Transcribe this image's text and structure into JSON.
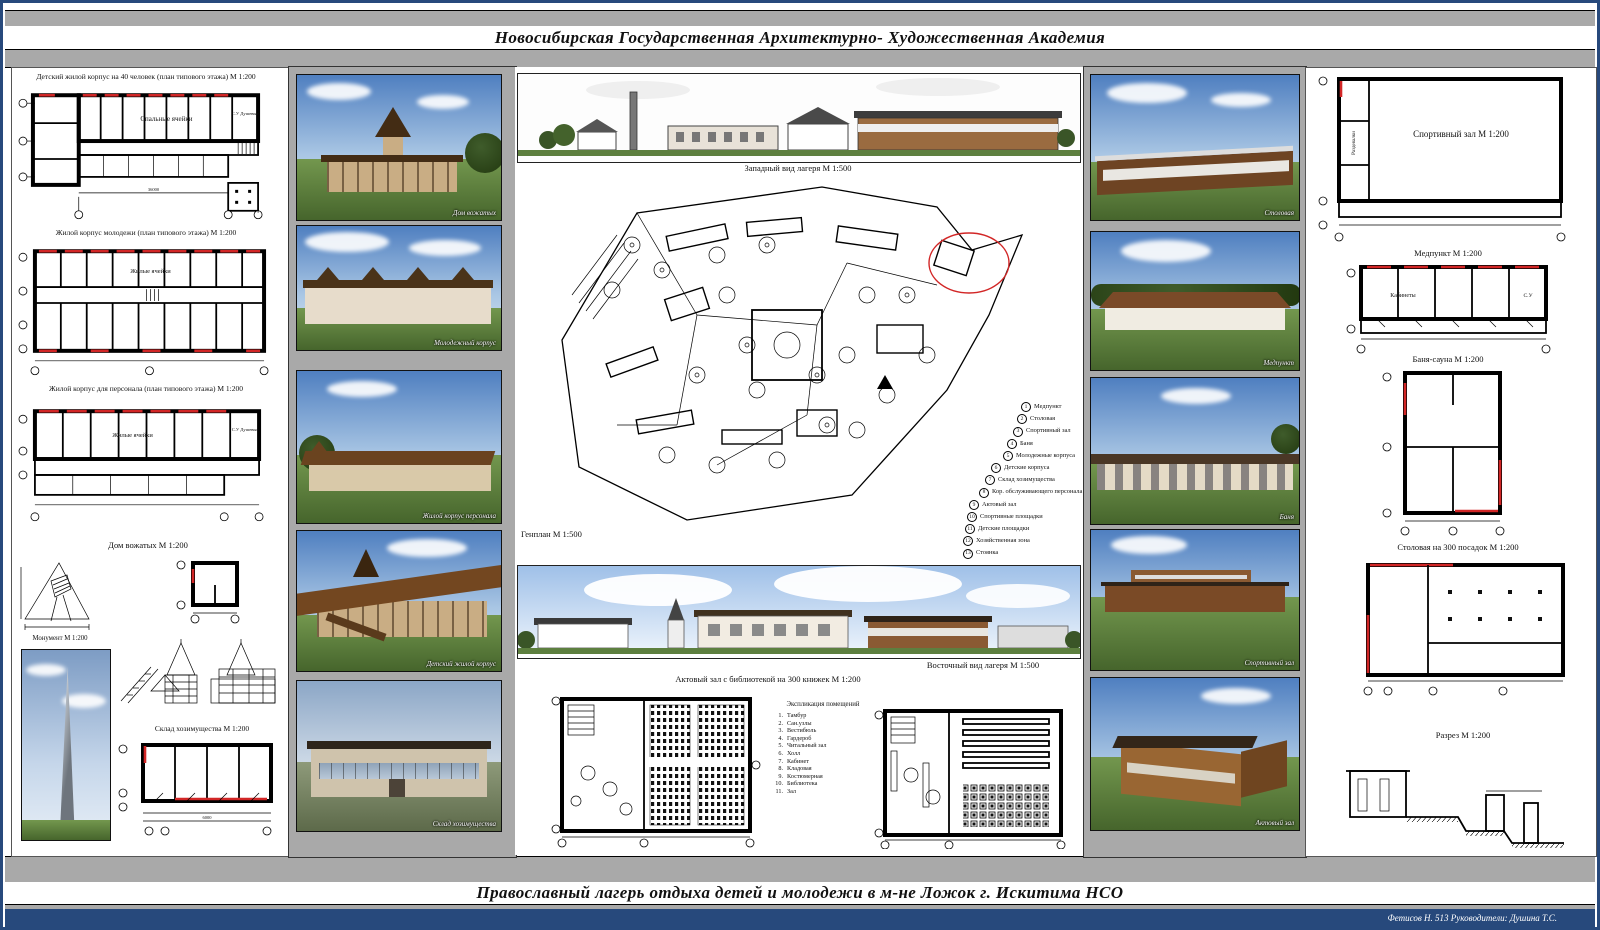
{
  "colors": {
    "accent_red": "#cc2222",
    "frame_gray": "#a9a9a9",
    "border_navy": "#27497c"
  },
  "header": {
    "academy": "Новосибирская Государственная Архитектурно- Художественная Академия"
  },
  "footer": {
    "project": "Православный лагерь отдыха детей и молодежи в м-не Ложок г. Искитима  НСО",
    "credits": "Фетисов Н. 513  Руководители: Душина Т.С."
  },
  "left": {
    "plan1": {
      "caption": "Детский жилой корпус на 40 человек (план типового этажа) М 1:200",
      "room1": "Спальные ячейки",
      "room2": "С.У Душевые"
    },
    "plan2": {
      "caption": "Жилой корпус молодежи (план типового этажа) М 1:200",
      "room1": "Жилые ячейки"
    },
    "plan3": {
      "caption": "Жилой корпус для персонала (план типового этажа) М 1:200",
      "room1": "Жилые ячейки",
      "room2": "С.У Душевые"
    },
    "dom": "Дом вожатых М 1:200",
    "monument": "Монумент М 1:200",
    "sklad": "Склад хозимущества М 1:200",
    "dims": {
      "cell": "6000",
      "total": "36000"
    }
  },
  "renders_left": [
    "Дом вожатых",
    "Молодежный корпус",
    "Жилой корпус персонала",
    "Детский жилой корпус",
    "Склад хозимущества"
  ],
  "center": {
    "west": "Западный вид лагеря М 1:500",
    "genplan": "Генплан М 1:500",
    "east": "Восточный вид лагеря М 1:500",
    "hall": "Актовый зал с библиотекой на 300 книжек М 1:200",
    "expl_title": "Экспликация помещений",
    "legend": [
      "Медпункт",
      "Столовая",
      "Спортивный зал",
      "Баня",
      "Молодежные корпуса",
      "Детские корпуса",
      "Склад хозимущества",
      "Кор. обслуживающего персонала",
      "Актовый зал",
      "Спортивные площадки",
      "Детские площадки",
      "Хозяйственная зона",
      "Стоянка"
    ],
    "explication": [
      "Тамбур",
      "Сан.узлы",
      "Вестибюль",
      "Гардероб",
      "Читальный зал",
      "Холл",
      "Кабинет",
      "Кладовая",
      "Костюмерная",
      "Библиотека",
      "Зал"
    ]
  },
  "renders_right": [
    "Столовая",
    "Медпункт",
    "Баня",
    "Спортивный зал",
    "Актовый зал"
  ],
  "right": {
    "sport_label": "Спортивный зал М 1:200",
    "sport_rooms": "Раздевалки",
    "medpunkt": "Медпункт М 1:200",
    "rooms_kab": "Кабинеты",
    "rooms_su": "С.У",
    "banya": "Баня-сауна М 1:200",
    "stolovaya": "Столовая на 300 посадок М 1:200",
    "razrez": "Разрез М 1:200"
  }
}
